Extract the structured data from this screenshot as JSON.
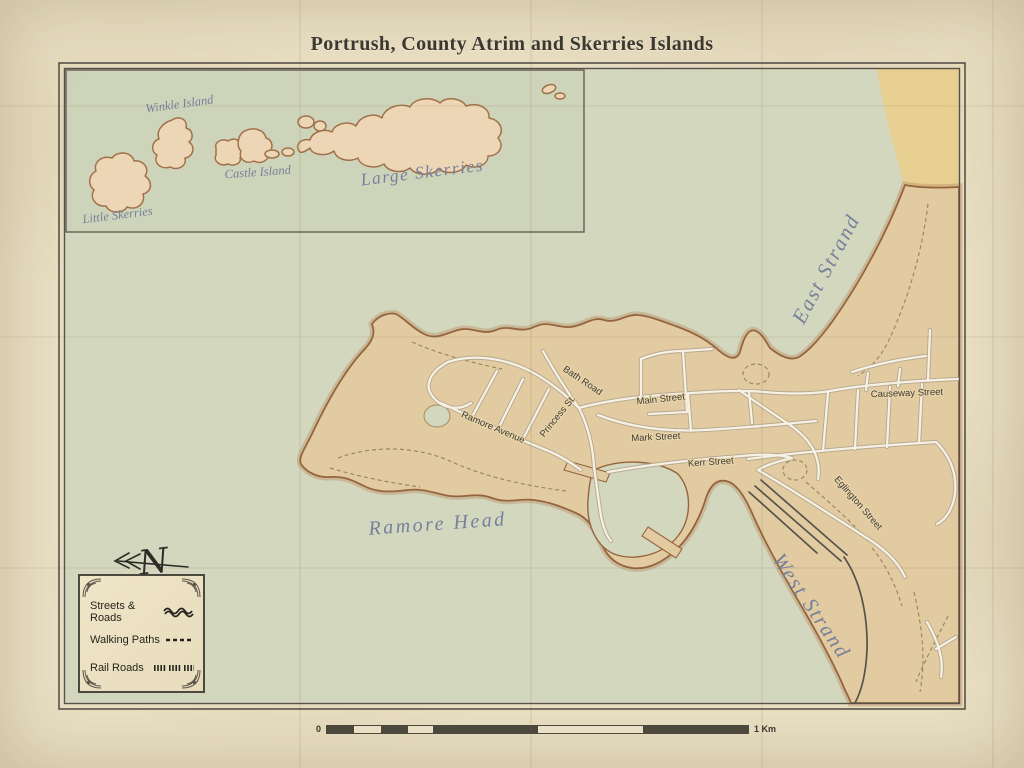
{
  "title": "Portrush, County Atrim and Skerries Islands",
  "inset_labels": {
    "winkle": "Winkle Island",
    "castle": "Castle Island",
    "large_skerries": "Large Skerries",
    "little_skerries": "Little Skerries"
  },
  "water_labels": {
    "east_strand": "East Strand",
    "west_strand": "West Strand",
    "ramore_head": "Ramore Head"
  },
  "street_labels": {
    "bath_road": "Bath Road",
    "main_street": "Main Street",
    "princess_st": "Princess St.",
    "ramore_avenue": "Ramore Avenue",
    "mark_street": "Mark Street",
    "kerr_street": "Kerr Street",
    "causeway_street": "Causeway Street",
    "eglington_street": "Eglington Street"
  },
  "compass": {
    "north_letter": "N"
  },
  "legend": {
    "items": [
      {
        "label": "Streets & Roads",
        "symbol": "wavy-line"
      },
      {
        "label": "Walking Paths",
        "symbol": "dashed-line"
      },
      {
        "label": "Rail Roads",
        "symbol": "railroad-ticks"
      }
    ]
  },
  "scale_bar": {
    "start_label": "0",
    "end_label": "1 Km"
  },
  "colors": {
    "parchment": "#e9dfc3",
    "sea": "#d3d7bd",
    "inset_sea": "#ced4b9",
    "land": "#e2cba1",
    "island": "#ecd6b5",
    "coast": "#96653f",
    "sand": "#e8cf92",
    "road_fill": "#f6f1e4",
    "road_casing": "#b5a88f",
    "rail": "#57534b",
    "water_label": "#76809d",
    "street_label": "#3e3c32",
    "frame": "#57534a",
    "scale_dark": "#4c483e",
    "scale_light": "#efe6cc"
  }
}
